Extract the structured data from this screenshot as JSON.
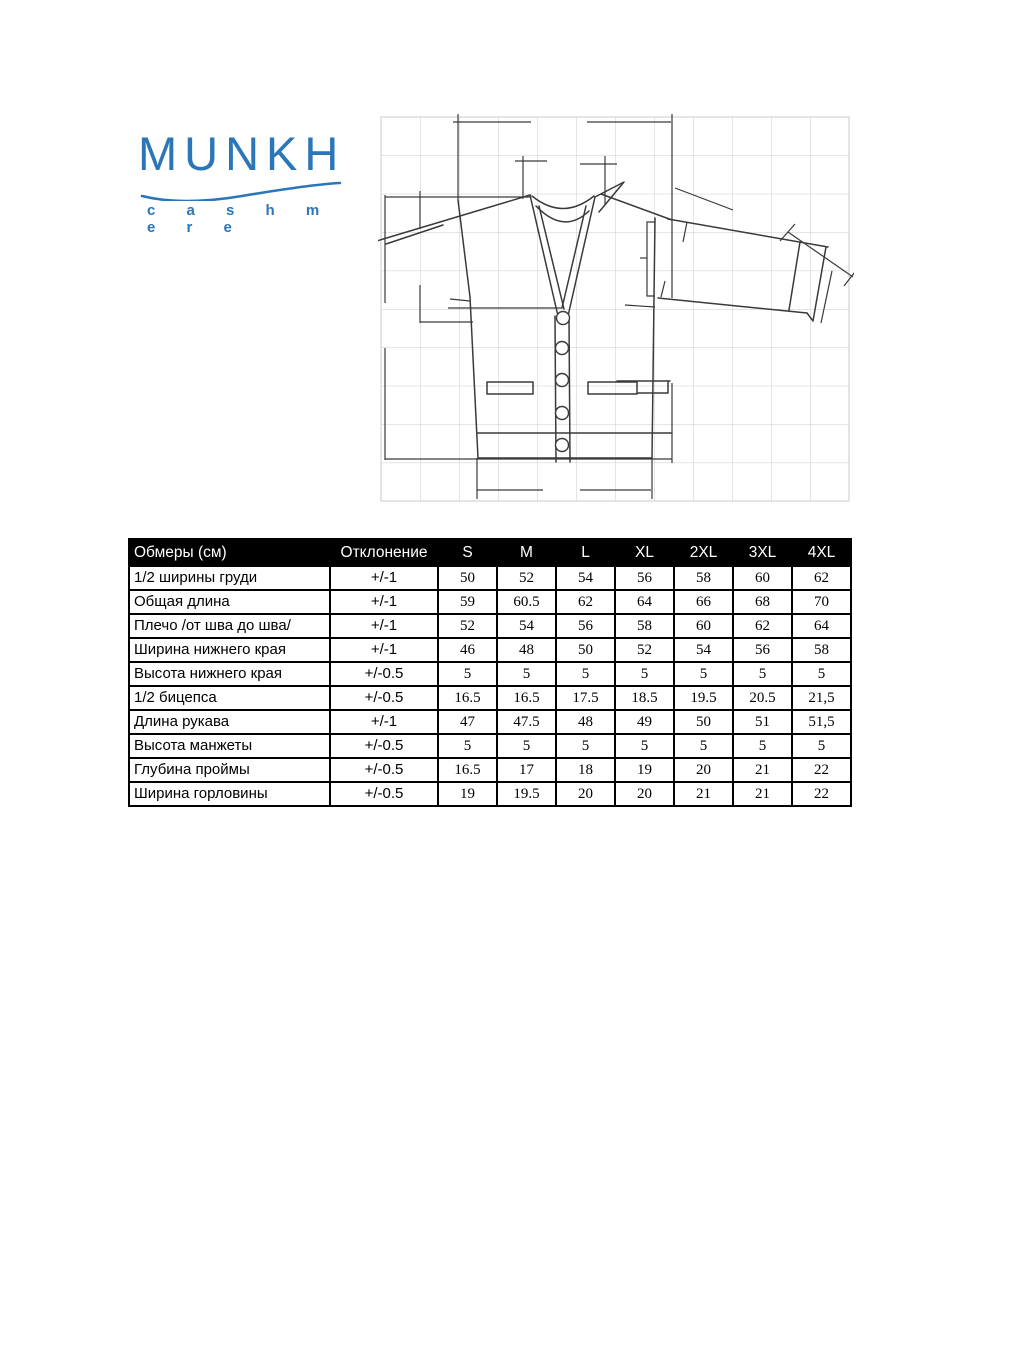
{
  "logo": {
    "brand": "MUNKH",
    "tagline": "c a s h m e r e",
    "brand_color": "#2b76b8"
  },
  "sketch": {
    "name": "cardigan-technical-drawing",
    "description": "Flat technical sketch of a V-neck button cardigan with dimension lines on a grid"
  },
  "size_table": {
    "measurements_header": "Обмеры (см)",
    "deviation_header": "Отклонение",
    "sizes": [
      "S",
      "M",
      "L",
      "XL",
      "2XL",
      "3XL",
      "4XL"
    ],
    "rows": [
      {
        "label": "1/2 ширины груди",
        "deviation": "+/-1",
        "values": [
          "50",
          "52",
          "54",
          "56",
          "58",
          "60",
          "62"
        ]
      },
      {
        "label": "Общая длина",
        "deviation": "+/-1",
        "values": [
          "59",
          "60.5",
          "62",
          "64",
          "66",
          "68",
          "70"
        ]
      },
      {
        "label": "Плечо /от шва до шва/",
        "deviation": "+/-1",
        "values": [
          "52",
          "54",
          "56",
          "58",
          "60",
          "62",
          "64"
        ]
      },
      {
        "label": "Ширина нижнего края",
        "deviation": "+/-1",
        "values": [
          "46",
          "48",
          "50",
          "52",
          "54",
          "56",
          "58"
        ]
      },
      {
        "label": "Высота нижнего края",
        "deviation": "+/-0.5",
        "values": [
          "5",
          "5",
          "5",
          "5",
          "5",
          "5",
          "5"
        ]
      },
      {
        "label": "1/2 бицепса",
        "deviation": "+/-0.5",
        "values": [
          "16.5",
          "16.5",
          "17.5",
          "18.5",
          "19.5",
          "20.5",
          "21,5"
        ]
      },
      {
        "label": "Длина рукава",
        "deviation": "+/-1",
        "values": [
          "47",
          "47.5",
          "48",
          "49",
          "50",
          "51",
          "51,5"
        ]
      },
      {
        "label": "Высота манжеты",
        "deviation": "+/-0.5",
        "values": [
          "5",
          "5",
          "5",
          "5",
          "5",
          "5",
          "5"
        ]
      },
      {
        "label": "Глубина проймы",
        "deviation": "+/-0.5",
        "values": [
          "16.5",
          "17",
          "18",
          "19",
          "20",
          "21",
          "22"
        ]
      },
      {
        "label": "Ширина горловины",
        "deviation": "+/-0.5",
        "values": [
          "19",
          "19.5",
          "20",
          "20",
          "21",
          "21",
          "22"
        ]
      }
    ]
  }
}
